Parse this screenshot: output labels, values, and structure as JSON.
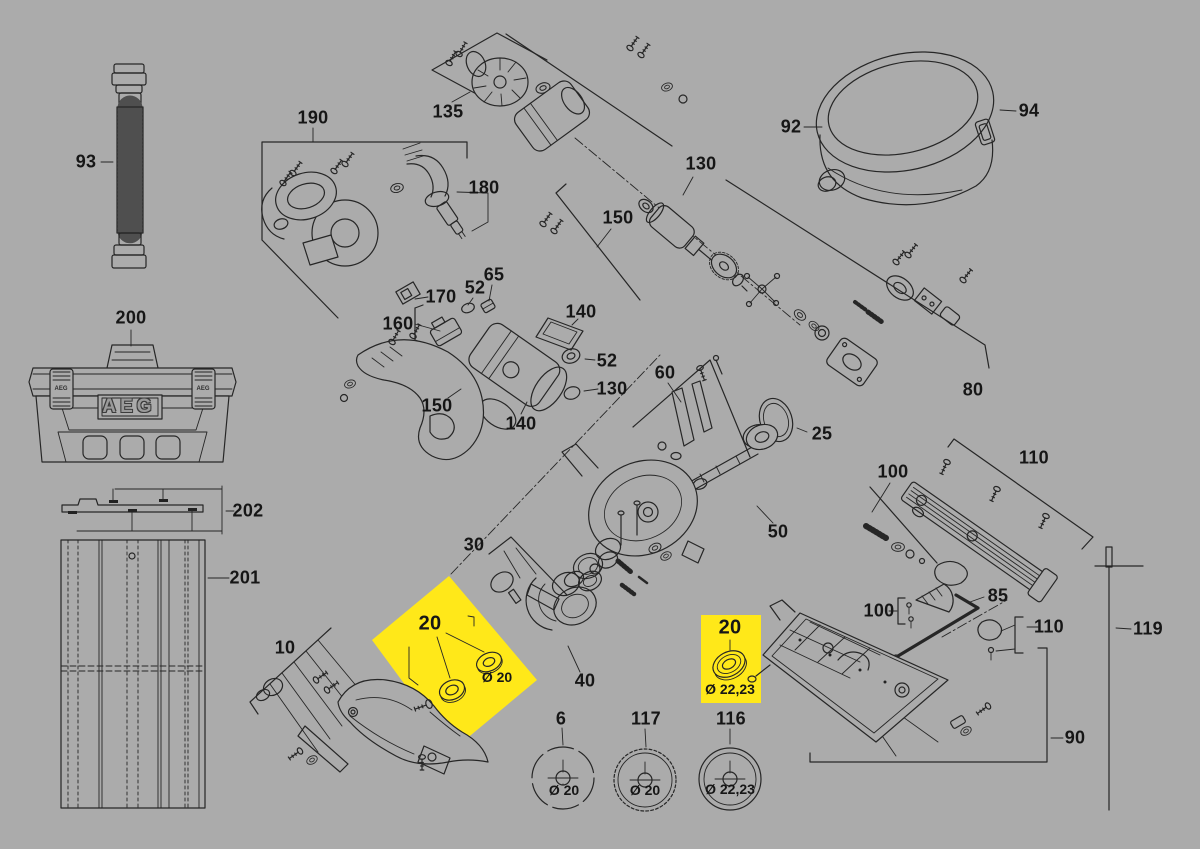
{
  "page": {
    "background": "#ABABAB",
    "ink": "#262626",
    "highlight": "#FFE819"
  },
  "brand": {
    "box_label": "AEG",
    "latch_left": "AEG",
    "latch_right": "AEG"
  },
  "callouts": {
    "c93": "93",
    "c200": "200",
    "c202": "202",
    "c201": "201",
    "c190": "190",
    "c135": "135",
    "c180": "180",
    "c130a": "130",
    "c150a": "150",
    "c92": "92",
    "c94": "94",
    "c170": "170",
    "c52a": "52",
    "c65": "65",
    "c160": "160",
    "c140a": "140",
    "c52b": "52",
    "c130b": "130",
    "c150b": "150",
    "c140b": "140",
    "c60": "60",
    "c25": "25",
    "c80": "80",
    "c50": "50",
    "c100a": "100",
    "c110a": "110",
    "c85": "85",
    "c100b": "100",
    "c110b": "110",
    "c119": "119",
    "c90": "90",
    "c30": "30",
    "c40": "40",
    "c10": "10",
    "c6": "6",
    "c117": "117",
    "c116": "116"
  },
  "highlights": [
    {
      "label": "20",
      "diameter": "Ø 20"
    },
    {
      "label": "20",
      "diameter": "Ø 22,23"
    }
  ],
  "blades": [
    {
      "label": "6",
      "diameter": "Ø 20"
    },
    {
      "label": "117",
      "diameter": "Ø 20"
    },
    {
      "label": "116",
      "diameter": "Ø 22,23"
    }
  ]
}
